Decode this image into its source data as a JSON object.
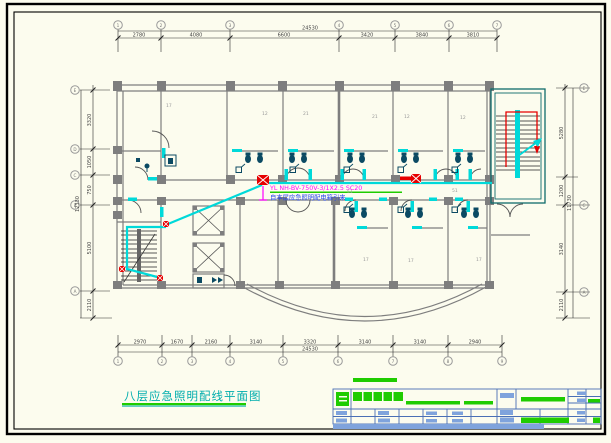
{
  "drawing": {
    "title": "八层应急照明配线平面图",
    "feeder_spec": "YL NH-BV-750V-3/1X2.5 SC20",
    "feeder_source": "自本层应急照明配电箱引来",
    "colors": {
      "background": "#FCFCEE",
      "walls": "#7E7E7E",
      "wiring_cyan": "#00D9D9",
      "emergency_red": "#E60000",
      "annotation_magenta": "#FF00FF",
      "source_note_blue": "#2244EE",
      "title_cyan": "#00ADAD",
      "underline_green": "#1FCC00",
      "titleblock_bar_green": "#1FCC00",
      "titleblock_bar_blue": "#7FA3DC",
      "stair_tower_teal": "#0E6B6B"
    },
    "grid": {
      "top_bubbles": [
        "1",
        "2",
        "3",
        "4",
        "5",
        "6",
        "7"
      ],
      "bottom_bubbles": [
        "1",
        "2",
        "3",
        "4",
        "5",
        "6",
        "7",
        "8",
        "9"
      ],
      "left_bubbles": [
        "E",
        "D",
        "C",
        "B",
        "A"
      ],
      "right_bubbles": [
        "E",
        "C",
        "A"
      ]
    },
    "dims": {
      "top": {
        "segments": [
          "2780",
          "4080",
          "6600",
          "3420",
          "3840",
          "3810"
        ],
        "total": "24530"
      },
      "bottom": {
        "segments": [
          "2970",
          "1670",
          "2160",
          "3140",
          "3320",
          "3140",
          "3140",
          "2940"
        ],
        "total": "24530"
      },
      "left": {
        "segments": [
          "3320",
          "1050",
          "750",
          "5100",
          "2110"
        ],
        "total": "12330"
      },
      "right": {
        "segments": [
          "5280",
          "1200",
          "3140",
          "2110"
        ],
        "total": "11730"
      }
    },
    "room_labels": [
      "17",
      "12",
      "21",
      "21",
      "12",
      "12",
      "51",
      "51",
      "17",
      "17",
      "17"
    ]
  }
}
